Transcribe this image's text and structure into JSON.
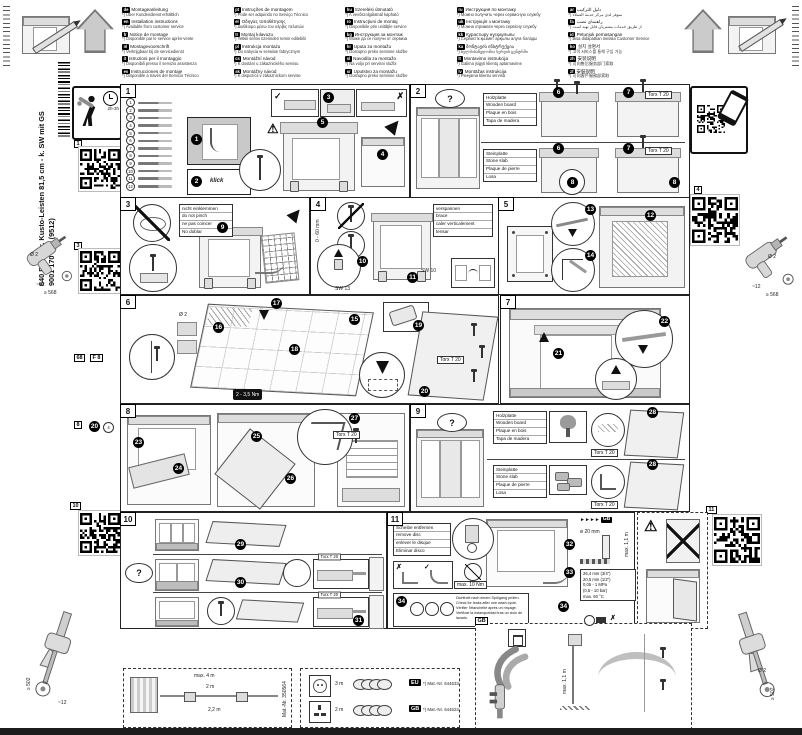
{
  "glyphs": {
    "check": "✓",
    "cross": "✗",
    "warn": "!",
    "question": "?",
    "gbarrows": "►►►►"
  },
  "doc": {
    "product_line1": "640 B Integr. Kusto-Leisten 81,5 cm - k. SW mit GS",
    "product_line2": "9001 170 046 (9512)",
    "install_time": "2h-3h"
  },
  "qr_labels": {
    "q1": "1",
    "q3": "3",
    "q4": "4",
    "q10": "10",
    "q11": "11"
  },
  "margin_marks": {
    "fold1": "68",
    "fold2": "F 8",
    "m8": "8",
    "m20": "20",
    "m4": "4",
    "drill_dia": "Ø 2",
    "offset": "~12",
    "depth": "≥ 568",
    "bottom_depth": "≥ 502"
  },
  "header": {
    "languages": [
      {
        "code": "de",
        "title": "Montageanleitung",
        "note": "*) Über Kundendienst erhältlich"
      },
      {
        "code": "en",
        "title": "Installation instructions",
        "note": "*) Available from customer service"
      },
      {
        "code": "fr",
        "title": "Notice de montage",
        "note": "*) Disponible par le service après-vente"
      },
      {
        "code": "nl",
        "title": "Montagevoorschrift",
        "note": "*) Verkrijgbaar bij de servicedienst"
      },
      {
        "code": "it",
        "title": "Istruzioni per il montaggio",
        "note": "*) Disponibili presso il servizio assistenza"
      },
      {
        "code": "es",
        "title": "Instrucciones de montaje",
        "note": "*) Disponible a través del Servicio Técnico"
      },
      {
        "code": "pt",
        "title": "Instruções de montagem",
        "note": "*) Pode ser adquirido no Serviço Técnico"
      },
      {
        "code": "el",
        "title": "Οδηγίες τοποθέτησης",
        "note": "*) Διαθέσιμο μέσω του σέρβις πελατών"
      },
      {
        "code": "tr",
        "title": "Montaj kılavuzu",
        "note": "*) Yetkili servis üzerinden temin edilebilir"
      },
      {
        "code": "pl",
        "title": "Instrukcja montażu",
        "note": "*) Do nabycia w serwisie fabrycznym"
      },
      {
        "code": "cs",
        "title": "Montážní návod",
        "note": "*) K dostání u zákaznického servisu"
      },
      {
        "code": "sk",
        "title": "Montážny návod",
        "note": "*) K dispozícii v zákazníckom servise"
      },
      {
        "code": "hu",
        "title": "Szerelési útmutató",
        "note": "*) A vevőszolgálatnál kapható"
      },
      {
        "code": "ro",
        "title": "Instrucţiuni de montaj",
        "note": "*) Disponibile prin unităţile service"
      },
      {
        "code": "bg",
        "title": "Инструкция за монтаж",
        "note": "*) Може да се получи от сервиза"
      },
      {
        "code": "hr",
        "title": "Uputa za montažu",
        "note": "*) Dostupno preko servisne službe"
      },
      {
        "code": "sl",
        "title": "Navodila za montažo",
        "note": "*) Na voljo pri servisni službi"
      },
      {
        "code": "sr",
        "title": "Uputstvo za montažu",
        "note": "*) Dostupno preko servisne službe"
      },
      {
        "code": "ru",
        "title": "Инструкция по монтажу",
        "note": "*) Можно получить через сервисную службу"
      },
      {
        "code": "uk",
        "title": "Інструкція з монтажу",
        "note": "*) Можна отримати через сервісну службу"
      },
      {
        "code": "kk",
        "title": "Құрастыру нұсқаулығы",
        "note": "*) Сервистік қызмет арқылы алуға болады"
      },
      {
        "code": "ka",
        "title": "მონტაჟის ინსტრუქცია",
        "note": "*) ხელმისაწვდომია სერვის ცენტრში"
      },
      {
        "code": "lt",
        "title": "Montavimo instrukcija",
        "note": "*) Galima įsigyti klientų aptarnavime"
      },
      {
        "code": "lv",
        "title": "Montāžas instrukcija",
        "note": "*) Pieejama klientu servisā"
      },
      {
        "code": "ar",
        "title": "دليل التركيب",
        "note": "*) متوفر لدى مركز خدمة العملاء"
      },
      {
        "code": "fa",
        "title": "راهنمای نصب",
        "note": "*) از طریق خدمات مشتریان قابل تهیه است"
      },
      {
        "code": "id",
        "title": "Petunjuk pemasangan",
        "note": "*) Bisa didapatkan melalui Customer Service"
      },
      {
        "code": "ko",
        "title": "설치 설명서",
        "note": "*) 고객 서비스를 통해 구입 가능"
      },
      {
        "code": "zh",
        "title": "安装说明",
        "note": "*) 可向售后服务部门索取"
      },
      {
        "code": "zf",
        "title": "安裝說明",
        "note": "*) 可向客戶服務部索取"
      }
    ]
  },
  "panels": {
    "p1": {
      "label": "1",
      "parts": [
        "1",
        "2",
        "3",
        "4",
        "5",
        "6",
        "7",
        "8",
        "9",
        "10",
        "11",
        "12"
      ],
      "s1": "1",
      "s2": "2",
      "s3": "3",
      "s4": "4",
      "s5": "5",
      "klick": "klick"
    },
    "p2": {
      "label": "2",
      "wood": [
        "Holzplatte",
        "Wooden board",
        "Plaque en bois",
        "Tapa de madera"
      ],
      "stone": [
        "Steinplatte",
        "Stone slab",
        "Plaque de pierre",
        "Losa"
      ],
      "s6": "6",
      "s7": "7",
      "s8": "8",
      "torx": "Torx T 20"
    },
    "p3": {
      "label": "3",
      "note": [
        "nicht einklemmen",
        "do not pinch",
        "ne pas coincer",
        "No doblar"
      ],
      "s9": "9"
    },
    "p4": {
      "label": "4",
      "note": [
        "verspannen",
        "brace",
        "caler verticalement",
        "tensar"
      ],
      "s10": "10",
      "s11": "11",
      "sw13": "SW 13",
      "sw10": "SW 10",
      "range": "0 - 60 mm"
    },
    "p5": {
      "label": "5",
      "s12": "12",
      "s13": "13",
      "s14": "14"
    },
    "p6": {
      "label": "6",
      "s15": "15",
      "s16": "16",
      "s17": "17",
      "s18": "18",
      "s19": "19",
      "s20": "20",
      "drill": "Ø 2",
      "torque": "2 - 3,5 Nm",
      "torx": "Torx T 20"
    },
    "p7": {
      "label": "7",
      "s21": "21",
      "s22": "22"
    },
    "p8": {
      "label": "8",
      "s23": "23",
      "s24": "24",
      "s25": "25",
      "s26": "26",
      "s27": "27",
      "torx": "Torx T 20"
    },
    "p9": {
      "label": "9",
      "wood": [
        "Holzplatte",
        "Wooden board",
        "Plaque en bois",
        "Tapa de madera"
      ],
      "stone": [
        "Steinplatte",
        "Stone slab",
        "Plaque de pierre",
        "Losa"
      ],
      "s28": "28",
      "torx": "Torx T 20"
    },
    "p10": {
      "label": "10",
      "s29": "29",
      "s30": "30",
      "s31": "31",
      "torx": "Torx T 20"
    },
    "p11": {
      "label": "11",
      "disc_note": [
        "Scheibe entfernen",
        "remove disc",
        "enlever le disque",
        "Eliminar disco"
      ],
      "leak_note": [
        "Dichtheit nach einem Spülgang prüfen.",
        "Check for leaks after one wash cycle.",
        "Vérifier l'étanchéité après un rinçage.",
        "Verificar la estanqueidad tras un ciclo de lavado."
      ],
      "s32": "32",
      "s33": "33",
      "s34": "34",
      "max_torque": "max. 10 Nm",
      "gb": "GB",
      "drain_dia": "ø 20 mm",
      "drain_h": "max. 1,1 m",
      "spec": [
        "26,4 mm (3/4\")",
        "20,5 mm (1/2\")",
        "0,05 - 1 MPa",
        "(0,5 - 10 bar)",
        "max. 60 °C"
      ]
    }
  },
  "bottom": {
    "hoses": {
      "max": "max. 4 m",
      "l1": "2 m",
      "l2": "2,2 m",
      "mat": "Mat.-Nr. 350564"
    },
    "cords": {
      "rows": [
        {
          "code": "EU",
          "len": "3 m",
          "mat": "*) Mat.-Nr. 644633"
        },
        {
          "code": "GB",
          "len": "2 m",
          "mat": "*) Mat.-Nr. 644624"
        }
      ]
    },
    "gb": {
      "label": "GB",
      "pipe_h": "max. 1,1 m"
    }
  }
}
